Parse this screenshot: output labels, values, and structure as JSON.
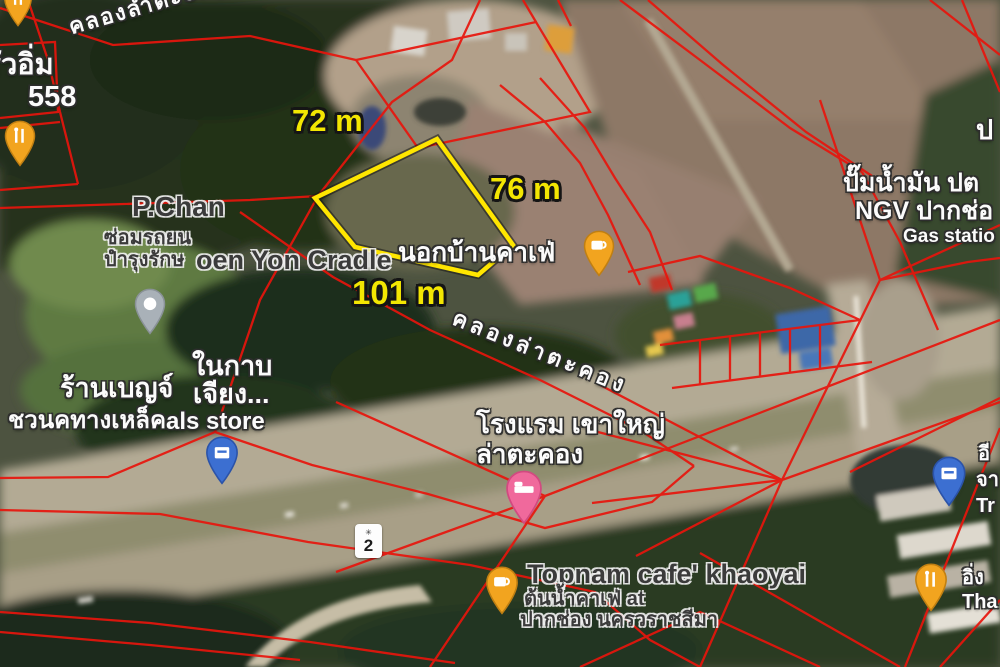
{
  "scene": {
    "description": "Satellite map view with red cadastral parcel overlay and a yellow-outlined land plot near Khlong Lam Takhong and Highway 2, Pak Chong"
  },
  "plot": {
    "outline_color": "#ffe600",
    "dimensions": {
      "top_edge": "72 m",
      "right_edge": "76 m",
      "bottom_edge": "101 m"
    }
  },
  "overlay": {
    "parcel_line_color": "#e8150d"
  },
  "road_shield": {
    "route_number": "2"
  },
  "pins": {
    "colors": {
      "food": "#F2A41F",
      "food_stroke": "#C07F12",
      "hotel": "#F0699C",
      "hotel_stroke": "#D14A80",
      "store_blue": "#3C6FD1",
      "store_blue_stroke": "#2B53A8",
      "generic_gray": "#A9B1B8",
      "generic_gray_stroke": "#8A9298"
    }
  },
  "labels": {
    "canal_top": "คลองลำตะong",
    "canal_mid": "คลองล่าตะคอง",
    "krua_im_line1": "ครัวอิ่ม",
    "krua_im_line2": "558",
    "p_chan": "P.Chan",
    "repair_line1": "ซ่อมรถยน",
    "repair_line2": "ปำรุงรักษ",
    "cradle": "oen Yon Cradle",
    "nokban_cafe": "นอกบ้านคาเฟ่",
    "nai_kap": "ในกาบ",
    "ran_benj": "ร้านเบญจ์",
    "jiang": "เจียง...",
    "store_thai": "ชวนคทางเหล็ค",
    "store_en": "als store",
    "hotel_line1": "โรงแรม เขาใหญ่",
    "hotel_line2": "ล่าตะคอง",
    "gas_line1": "ปั๊มน้ำมัน ปต",
    "gas_line2": "NGV ปากช่อ",
    "gas_line3": "Gas statio",
    "corner_partial": "ป",
    "topnam_line1": "Topnam cafe' khaoyai",
    "topnam_line2": "ต้นน้ำคาเฟ่ at",
    "topnam_line3": "ปากช่อง นครวราชสีมา",
    "edge_line1": "อี",
    "edge_line2": "จา",
    "edge_line3": "Tr",
    "edge_line4": "อิ่ง",
    "edge_line5": "Tha"
  }
}
